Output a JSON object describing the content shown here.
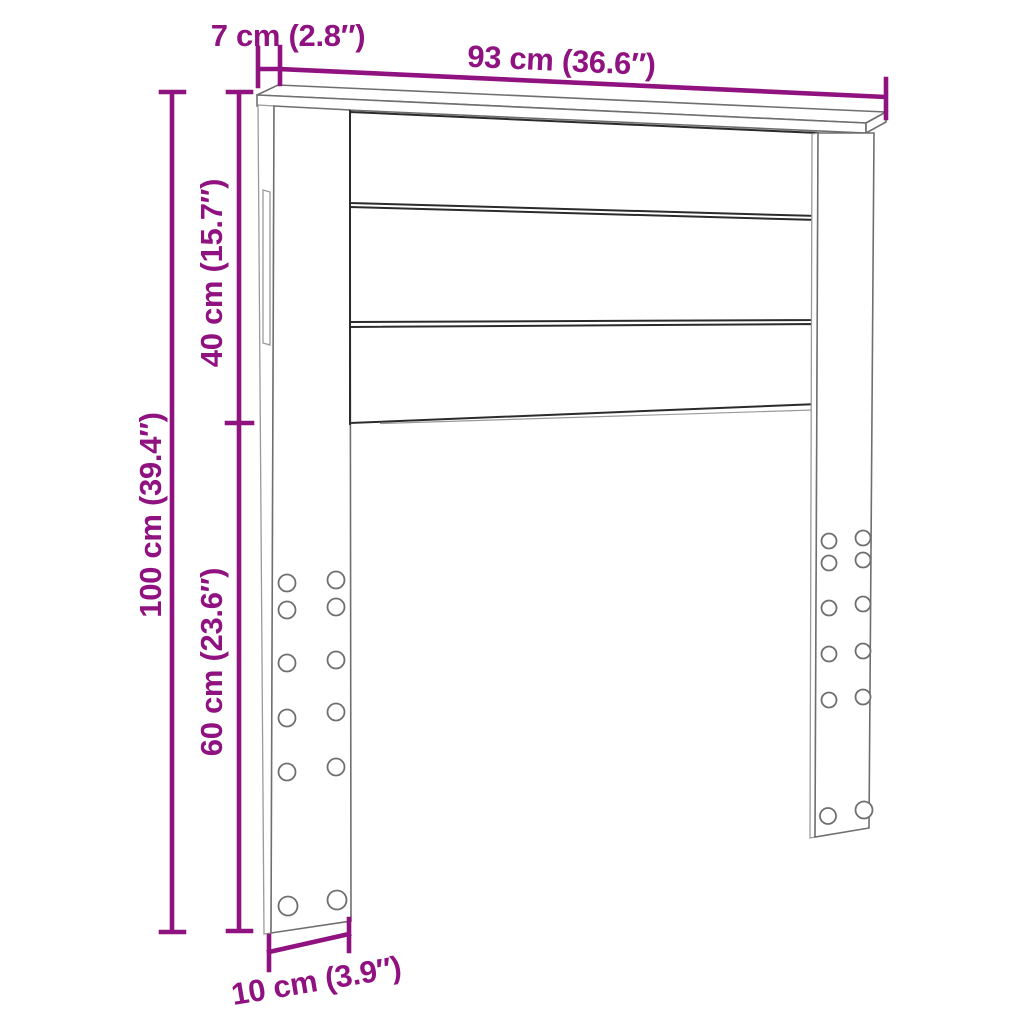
{
  "colors": {
    "accent": "#8F1280",
    "outline-dark": "#2b2b2b",
    "outline-mid": "#6f6f6f",
    "outline-light": "#9a9a9a"
  },
  "labels": {
    "cap_depth": "7 cm (2.8″)",
    "width": "93 cm (36.6″)",
    "upper_height": "40 cm (15.7″)",
    "total_height": "100 cm (39.4″)",
    "lower_height": "60 cm (23.6″)",
    "leg_depth": "10 cm (3.9″)"
  }
}
